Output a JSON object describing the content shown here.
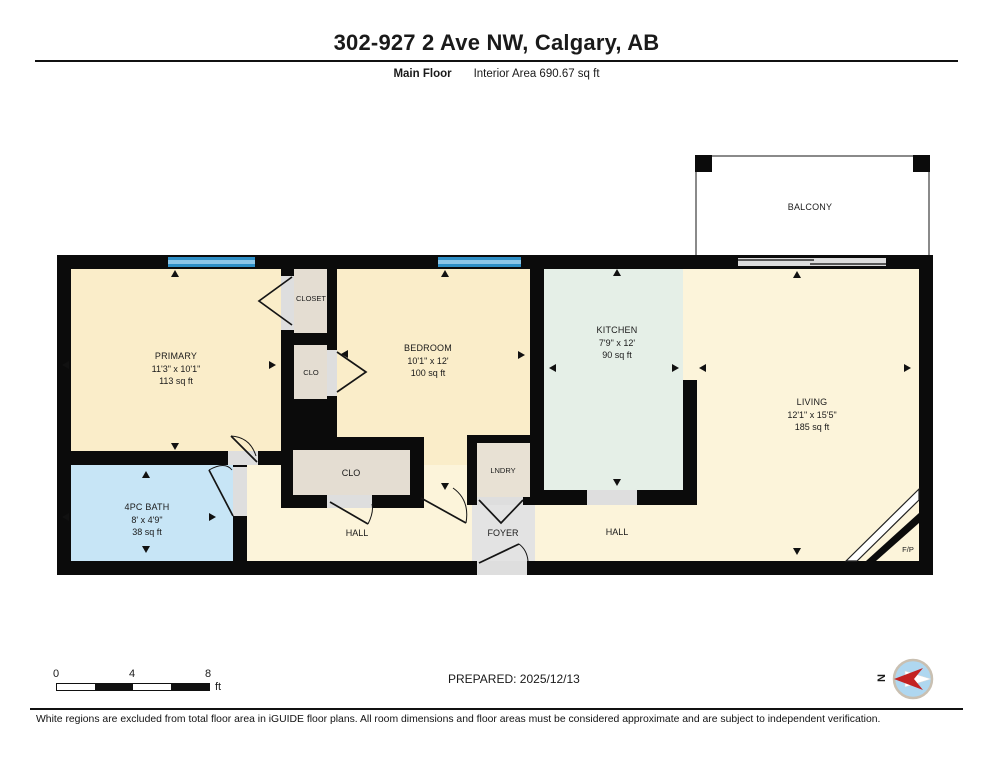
{
  "header": {
    "title": "302-927 2 Ave NW, Calgary, AB",
    "floor_label": "Main Floor",
    "area_label": "Interior Area 690.67 sq ft"
  },
  "rooms": {
    "primary": {
      "name": "PRIMARY",
      "dims": "11'3\" x 10'1\"",
      "area": "113 sq ft"
    },
    "closet": {
      "name": "CLOSET"
    },
    "clo_primary": {
      "name": "CLO"
    },
    "bedroom": {
      "name": "BEDROOM",
      "dims": "10'1\" x 12'",
      "area": "100 sq ft"
    },
    "kitchen": {
      "name": "KITCHEN",
      "dims": "7'9\" x 12'",
      "area": "90 sq ft"
    },
    "living": {
      "name": "LIVING",
      "dims": "12'1\" x 15'5\"",
      "area": "185 sq ft"
    },
    "balcony": {
      "name": "BALCONY"
    },
    "bath": {
      "name": "4PC BATH",
      "dims": "8' x 4'9\"",
      "area": "38 sq ft"
    },
    "clo_hall": {
      "name": "CLO"
    },
    "lndry": {
      "name": "LNDRY"
    },
    "foyer": {
      "name": "FOYER"
    },
    "hall_left": {
      "name": "HALL"
    },
    "hall_right": {
      "name": "HALL"
    },
    "fireplace": {
      "name": "F/P"
    }
  },
  "scale": {
    "tick0": "0",
    "tick1": "4",
    "tick2": "8",
    "unit": "ft"
  },
  "compass": {
    "north_label": "N"
  },
  "footer": {
    "prepared": "PREPARED: 2025/12/13",
    "disclaimer": "White regions are excluded from total floor area in iGUIDE floor plans. All room dimensions and floor areas must be considered approximate and are subject to independent verification."
  },
  "colors": {
    "wall": "#0b0b0b",
    "room_cream": "#FAEDC9",
    "room_cream_light": "#FCF4DA",
    "kitchen_green": "#E5EFE7",
    "bath_blue": "#C7E5F6",
    "closet_gray": "#E4DDD2",
    "door_gray": "#DEDEDE",
    "window_blue": "#2E8FC6",
    "window_light": "#8CC6E8",
    "compass_red": "#C32222",
    "compass_blue": "#AFD7F0"
  }
}
